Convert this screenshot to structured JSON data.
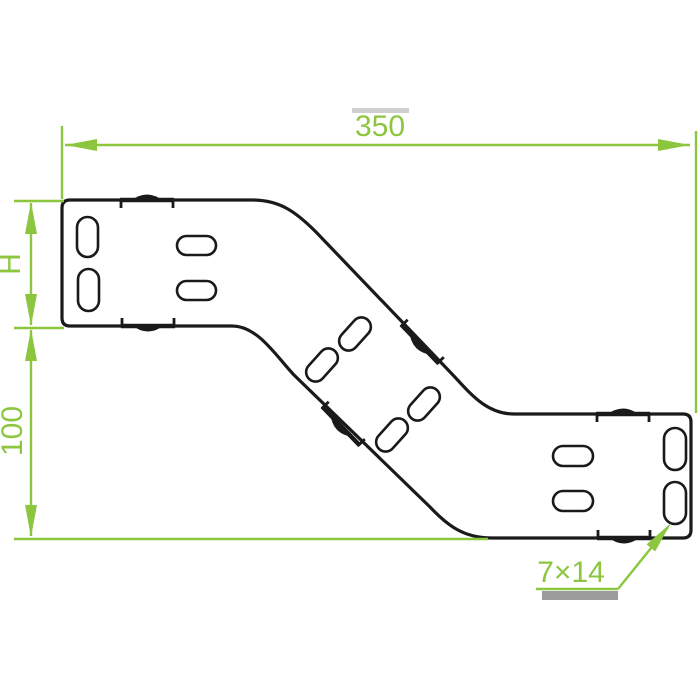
{
  "drawing": {
    "dim_width": {
      "label": "350"
    },
    "dim_height_side": {
      "label": "H"
    },
    "dim_height_drop": {
      "label": "100"
    },
    "dim_slot_size": {
      "label": "7×14"
    }
  },
  "colors": {
    "dimension_green": "#8CC63F",
    "outline_black": "#1A1A1A",
    "shadow_gray": "#9C9C9C",
    "background_white": "#FFFFFF"
  }
}
